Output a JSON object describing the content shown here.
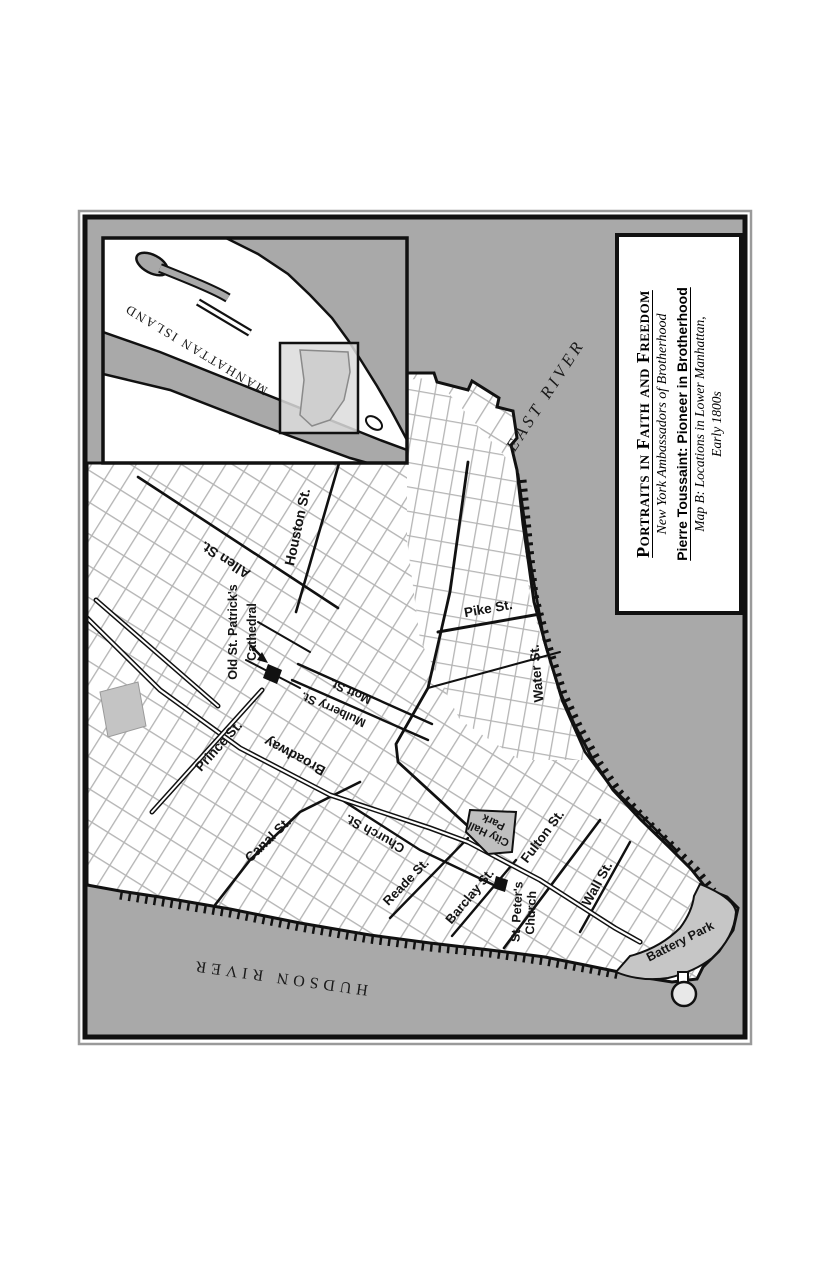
{
  "title_box": {
    "line1": "Portraits in Faith and Freedom",
    "line2": "New York Ambassadors of Brotherhood",
    "line3": "Pierre Toussaint: Pioneer in Brotherhood",
    "line4": "Map B: Locations in Lower Manhattan,",
    "line5": "Early 1800s"
  },
  "inset": {
    "island_label": "MANHATTAN ISLAND"
  },
  "water_labels": {
    "east_river": "EAST RIVER",
    "hudson_river": "HUDSON RIVER"
  },
  "street_labels": {
    "houston": "Houston St.",
    "allen": "Allen St.",
    "pike": "Pike St.",
    "water": "Water St.",
    "mott": "Mott St.",
    "mulberry": "Mulberry St.",
    "prince": "Prince St.",
    "broadway": "Broadway",
    "canal": "Canal St.",
    "church": "Church St.",
    "reade": "Reade St.",
    "barclay": "Barclay St.",
    "fulton": "Fulton St.",
    "wall": "Wall St."
  },
  "landmarks": {
    "old_st_patricks_line1": "Old St. Patrick's",
    "old_st_patricks_line2": "Cathedral",
    "st_peters_line1": "St. Peter's",
    "st_peters_line2": "Church",
    "city_hall_line1": "City Hall",
    "city_hall_line2": "Park",
    "battery_park": "Battery Park"
  },
  "colors": {
    "river": "#a9a9a9",
    "land": "#ffffff",
    "outline": "#111111",
    "minor_grid": "#b5b5b5",
    "park_fill": "#bfbfbf",
    "battery_fill": "#c6c6c6",
    "inset_highlight": "#dcdcdc"
  }
}
